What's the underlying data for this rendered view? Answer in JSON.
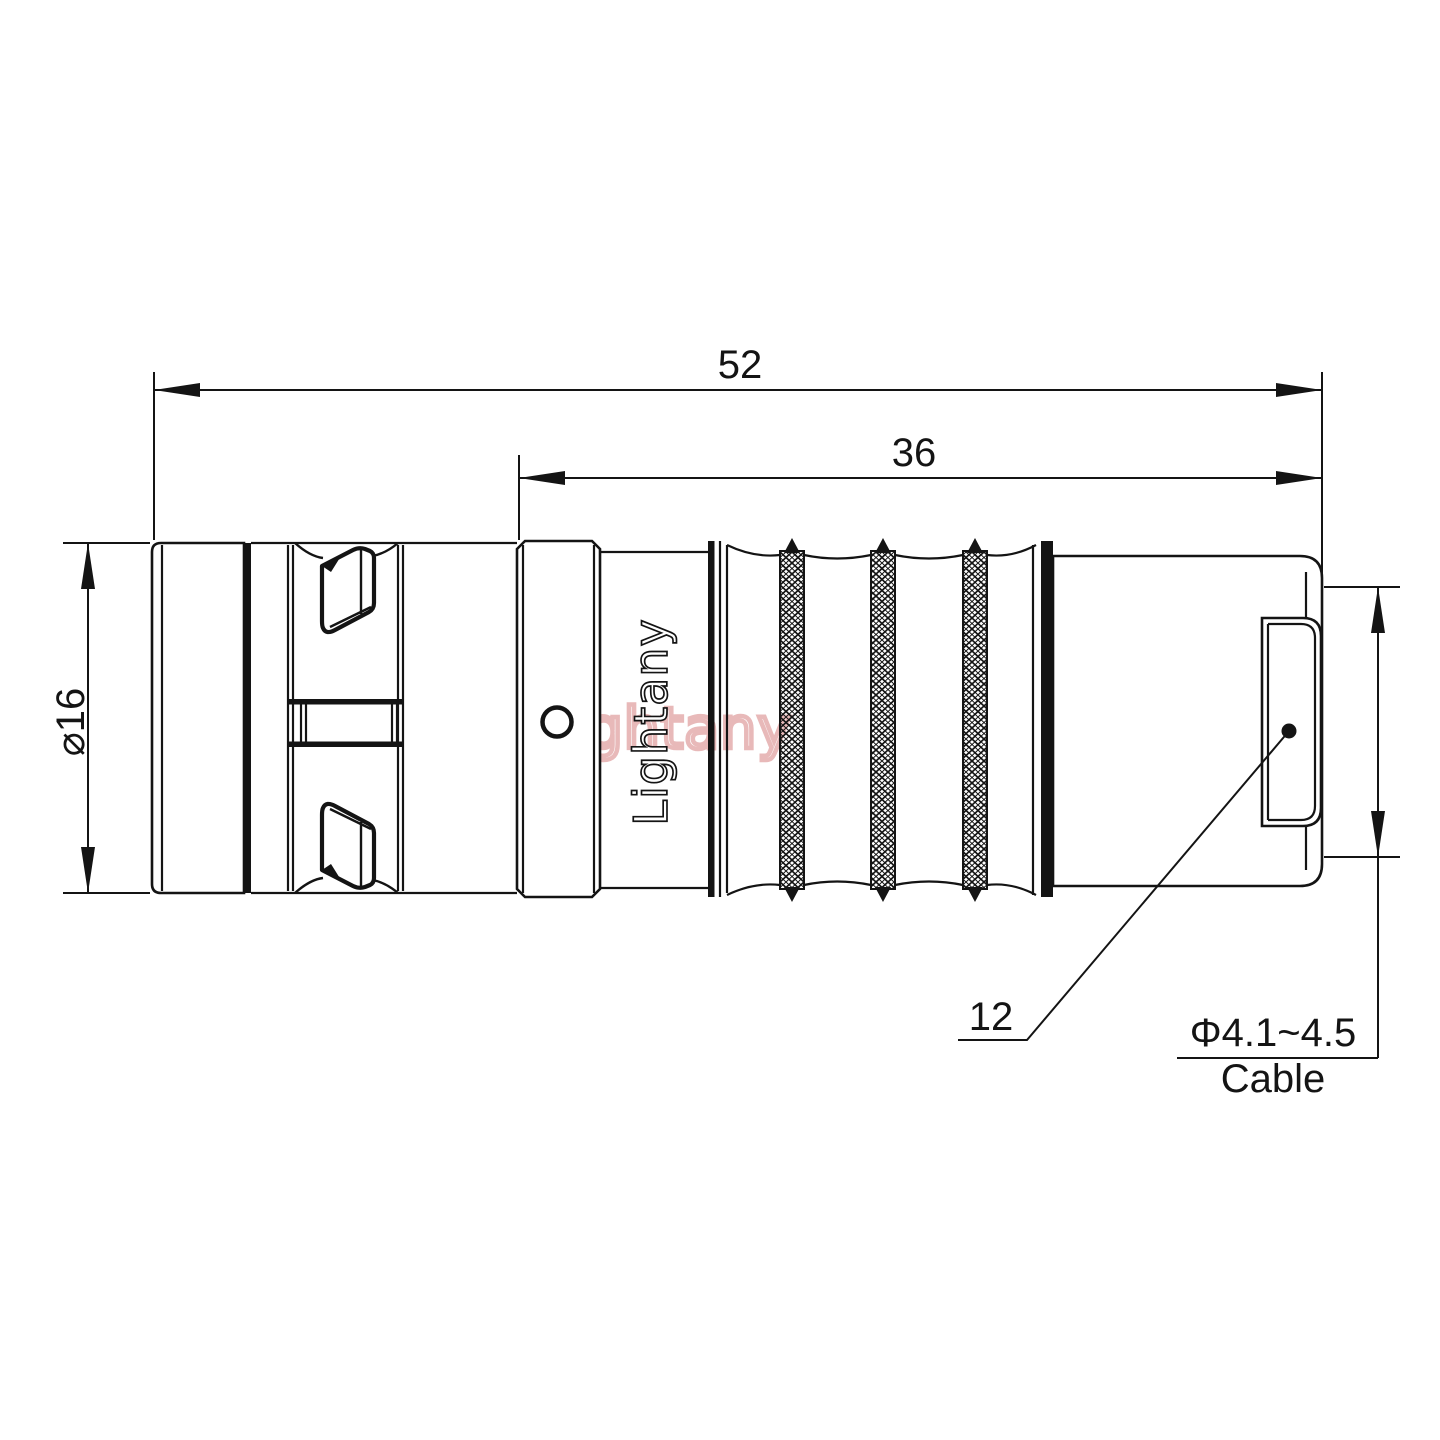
{
  "drawing": {
    "type": "connector technical drawing",
    "watermark": {
      "text": "Lightany",
      "color": "#d98b8b"
    },
    "brand": {
      "text": "Lightany"
    },
    "dims": {
      "overall_length": "52",
      "rear_length": "36",
      "diameter": "⌀16",
      "boot_width": "12",
      "cable_spec": "Φ4.1~4.5",
      "cable_word": "Cable"
    },
    "colors": {
      "line": "#141414",
      "background": "#ffffff",
      "watermark_pink": "#d98b8b"
    }
  }
}
